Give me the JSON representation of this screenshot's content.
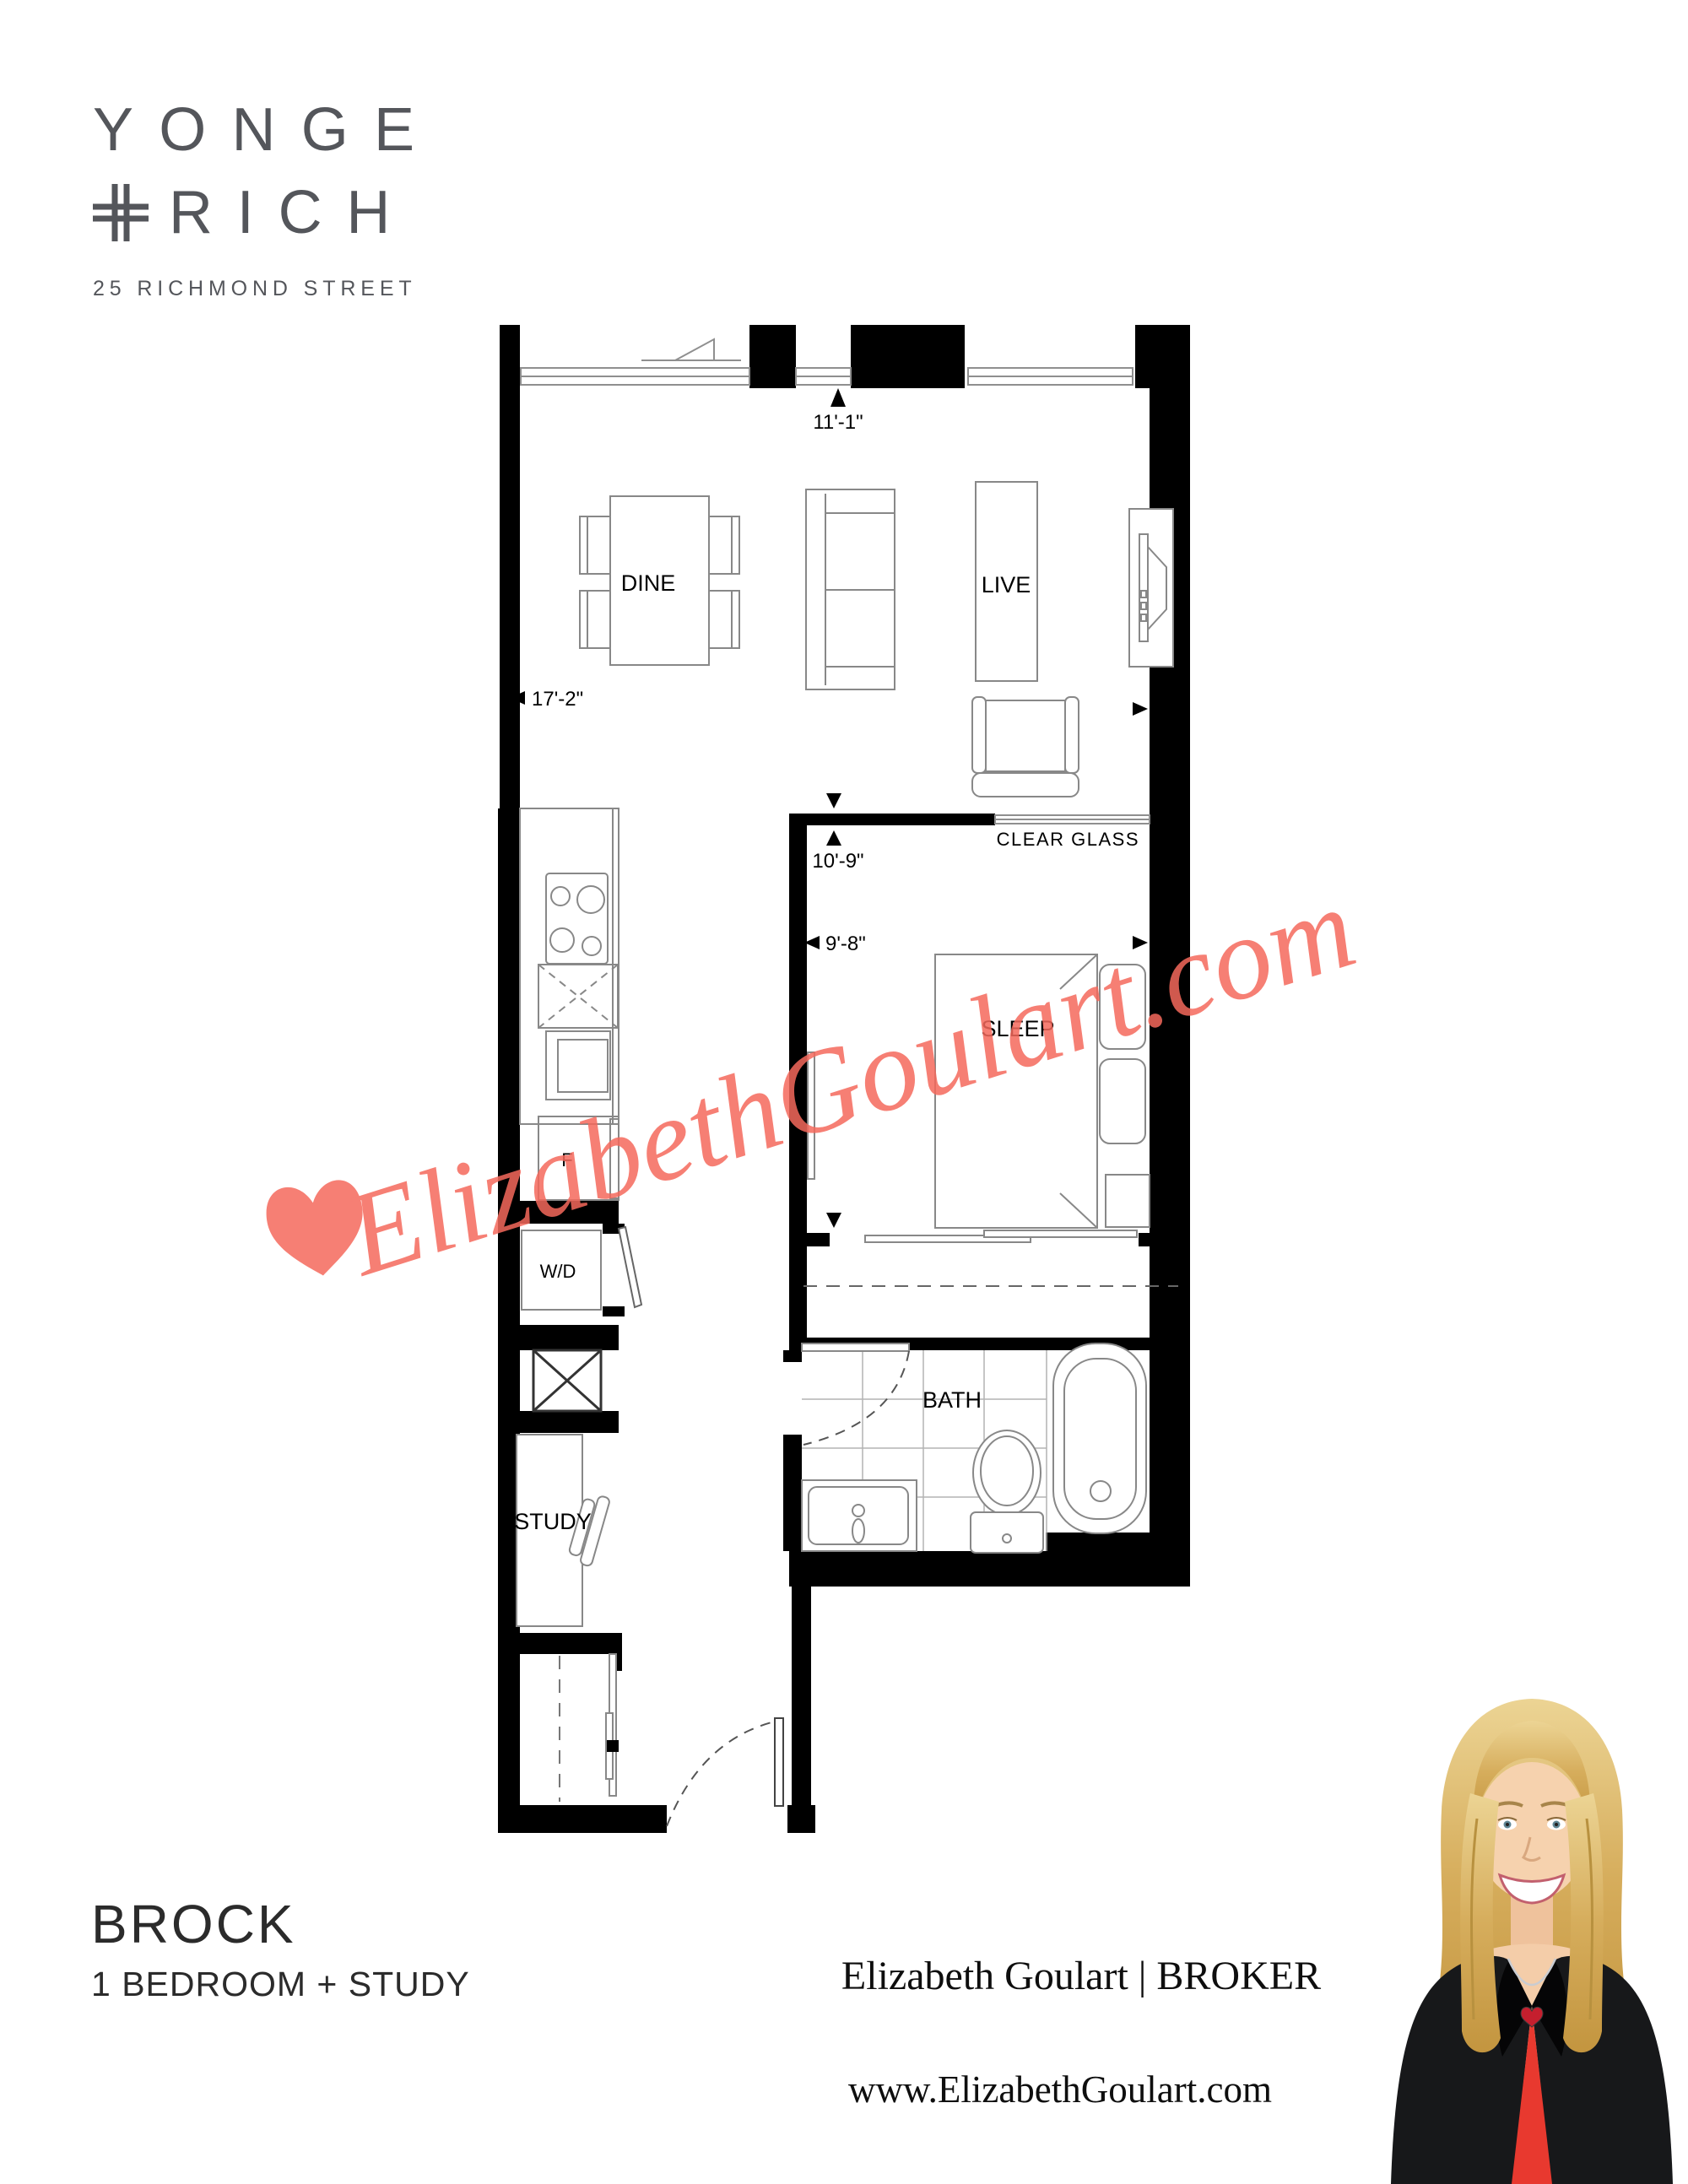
{
  "logo": {
    "line1": "YONGE",
    "plus_symbol": "+",
    "line2": "RICH",
    "address": "25 RICHMOND STREET",
    "color": "#54565b"
  },
  "floor_plan": {
    "rooms": {
      "dine": "DINE",
      "live": "LIVE",
      "sleep": "SLEEP",
      "bath": "BATH",
      "study": "STUDY",
      "washer_dryer": "W/D",
      "fridge": "F"
    },
    "dimensions": {
      "window_width": "11'-1\"",
      "living_width": "17'-2\"",
      "living_depth": "10'-9\"",
      "bedroom_width": "9'-8\""
    },
    "notes": {
      "glass_wall": "CLEAR GLASS"
    }
  },
  "watermark": {
    "heart_icon": "heart",
    "text": "ElizabethGoulart.com",
    "color": "#f5695c"
  },
  "footer": {
    "unit_name": "BROCK",
    "unit_type": "1 BEDROOM + STUDY",
    "broker_line": "Elizabeth Goulart | BROKER",
    "website": "www.ElizabethGoulart.com"
  }
}
